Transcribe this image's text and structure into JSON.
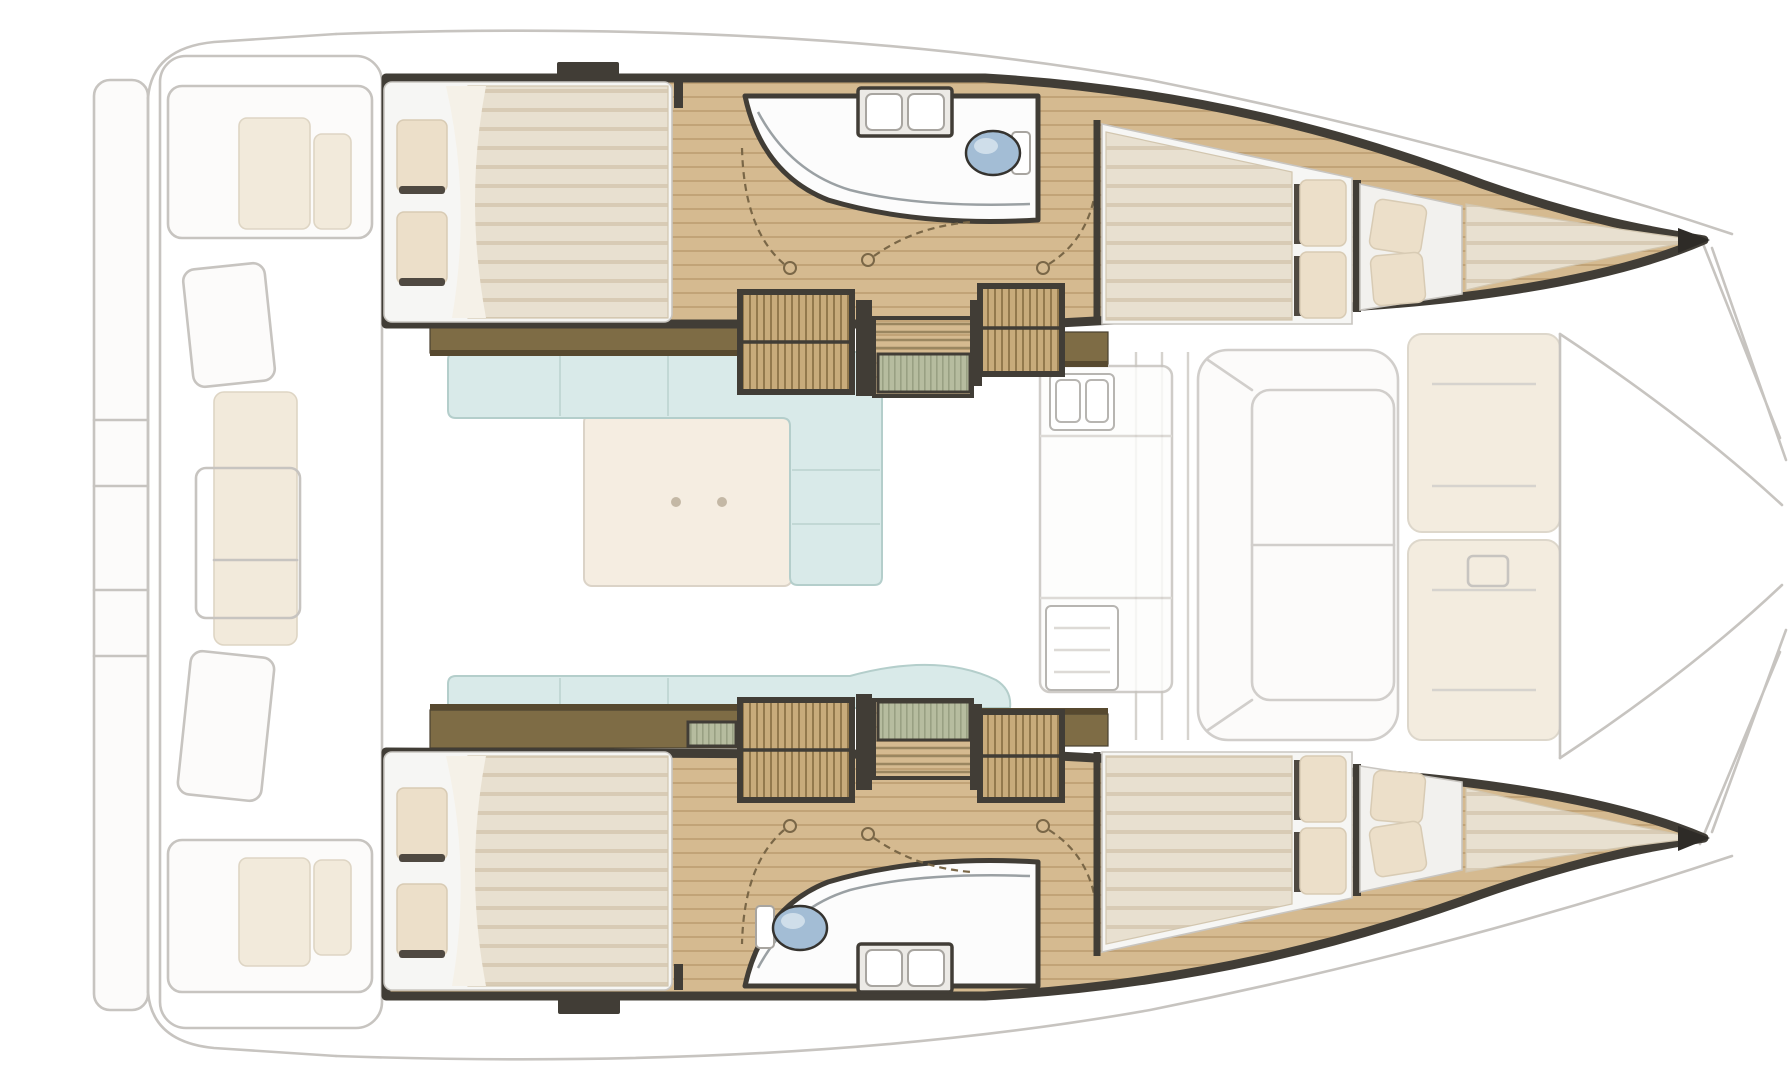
{
  "meta": {
    "title": "Catamaran yacht interior layout - top-down floor plan",
    "view": "plan view, bow pointing right",
    "canvas": {
      "width": 1792,
      "height": 1080
    }
  },
  "colors": {
    "background": "#ffffff",
    "ghost_line": "#c7c4c0",
    "ghost_fill": "#fcfbfa",
    "cushion": "#f2eadb",
    "cream_panel": "#f3ecdf",
    "wood": "#d5ba90",
    "wood_line": "#c1a377",
    "wall_dark": "#413d36",
    "wall_olive": "#7e6c45",
    "shelf_edge": "#57492f",
    "cabinet": "#c8ab7b",
    "cabinet_line": "#93794d",
    "mattress": "#e8e0d0",
    "mattress_stripe": "#d8cbb5",
    "bed_frame": "#f6f6f4",
    "pillow": "#ecdfc9",
    "pillow_shadow": "#4f4941",
    "bath_white": "#fcfcfc",
    "toilet_blue": "#a3bdd5",
    "sofa_blue": "#d9eae9",
    "table_beige": "#f2e7d7",
    "stair_mat": "#b6bc9f",
    "door_dash": "#7a6747",
    "glass": "#9aa0a3",
    "fixture_line": "#a8a5a0"
  },
  "layout": {
    "vessel": "sailing catamaran, two hulls joined by bridge-deck salon",
    "ghosted_exterior": [
      "stern steps",
      "aft cockpit with bench cushions",
      "helm seats",
      "foredeck lounge pads",
      "forward cockpit",
      "bow trampoline lines"
    ],
    "salon": [
      "L-shaped sofa",
      "chaise sofa",
      "coffee table with two fittings",
      "galley counter with sink and stove",
      "forward window mullions"
    ],
    "upper_hull": [
      "aft double cabin with pillows",
      "bathroom: shower, twin sinks, toilet",
      "two hatched wardrobes",
      "companionway stairs with mat",
      "three swing doors",
      "forward double cabin",
      "forepeak berth with two pillows",
      "bow tip"
    ],
    "lower_hull": [
      "aft double cabin with pillows",
      "bathroom: shower, twin sinks, toilet",
      "two hatched wardrobes",
      "companionway stairs with mat",
      "three swing doors",
      "forward double cabin",
      "forepeak berth with two pillows",
      "bow tip"
    ]
  },
  "fixtures": {
    "double_beds": 4,
    "forepeak_berths": 2,
    "bed_pillows": 12,
    "toilets": 2,
    "bathroom_basins": 4,
    "galley_sink_basins": 2,
    "stove": 1,
    "wardrobes": 4,
    "stair_flights": 2,
    "door_swings": 6
  }
}
